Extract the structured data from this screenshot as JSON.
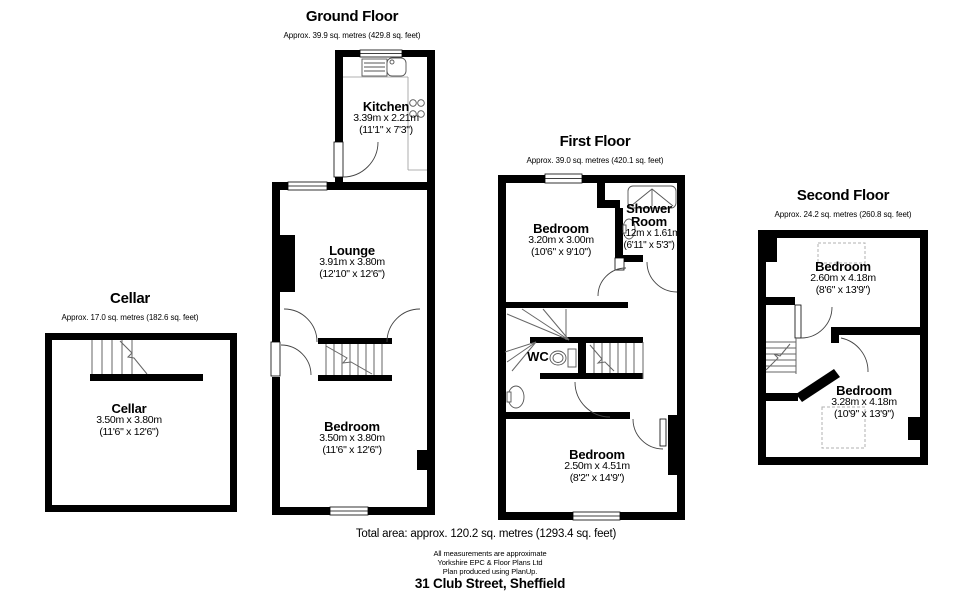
{
  "colors": {
    "wall": "#000000",
    "background": "#ffffff",
    "thin_line": "#666666",
    "dashed_line": "#b0b0b0"
  },
  "floors": {
    "cellar": {
      "title": "Cellar",
      "area": "Approx. 17.0 sq. metres (182.6 sq. feet)"
    },
    "ground": {
      "title": "Ground Floor",
      "area": "Approx. 39.9 sq. metres (429.8 sq. feet)"
    },
    "first": {
      "title": "First Floor",
      "area": "Approx. 39.0 sq. metres (420.1 sq. feet)"
    },
    "second": {
      "title": "Second Floor",
      "area": "Approx. 24.2 sq. metres (260.8 sq. feet)"
    }
  },
  "rooms": {
    "cellar_room": {
      "name": "Cellar",
      "metric": "3.50m x 3.80m",
      "imperial": "(11'6\" x 12'6\")"
    },
    "kitchen": {
      "name": "Kitchen",
      "metric": "3.39m x 2.21m",
      "imperial": "(11'1\" x 7'3\")"
    },
    "lounge": {
      "name": "Lounge",
      "metric": "3.91m x 3.80m",
      "imperial": "(12'10\" x 12'6\")"
    },
    "gf_bedroom": {
      "name": "Bedroom",
      "metric": "3.50m x 3.80m",
      "imperial": "(11'6\" x 12'6\")"
    },
    "ff_bedroom_front": {
      "name": "Bedroom",
      "metric": "3.20m x 3.00m",
      "imperial": "(10'6\" x 9'10\")"
    },
    "shower": {
      "line1": "Shower",
      "line2": "Room",
      "metric": "2.12m x 1.61m",
      "imperial": "(6'11\" x 5'3\")"
    },
    "wc": {
      "name": "WC"
    },
    "ff_bedroom_back": {
      "name": "Bedroom",
      "metric": "2.50m x 4.51m",
      "imperial": "(8'2\" x 14'9\")"
    },
    "sf_bedroom_front": {
      "name": "Bedroom",
      "metric": "2.60m x 4.18m",
      "imperial": "(8'6\" x 13'9\")"
    },
    "sf_bedroom_back": {
      "name": "Bedroom",
      "metric": "3.28m x 4.18m",
      "imperial": "(10'9\" x 13'9\")"
    }
  },
  "footer": {
    "total": "Total area: approx. 120.2 sq. metres (1293.4 sq. feet)",
    "note1": "All measurements are approximate",
    "note2": "Yorkshire EPC & Floor Plans  Ltd",
    "note3": "Plan produced using PlanUp.",
    "address": "31 Club Street, Sheffield"
  }
}
